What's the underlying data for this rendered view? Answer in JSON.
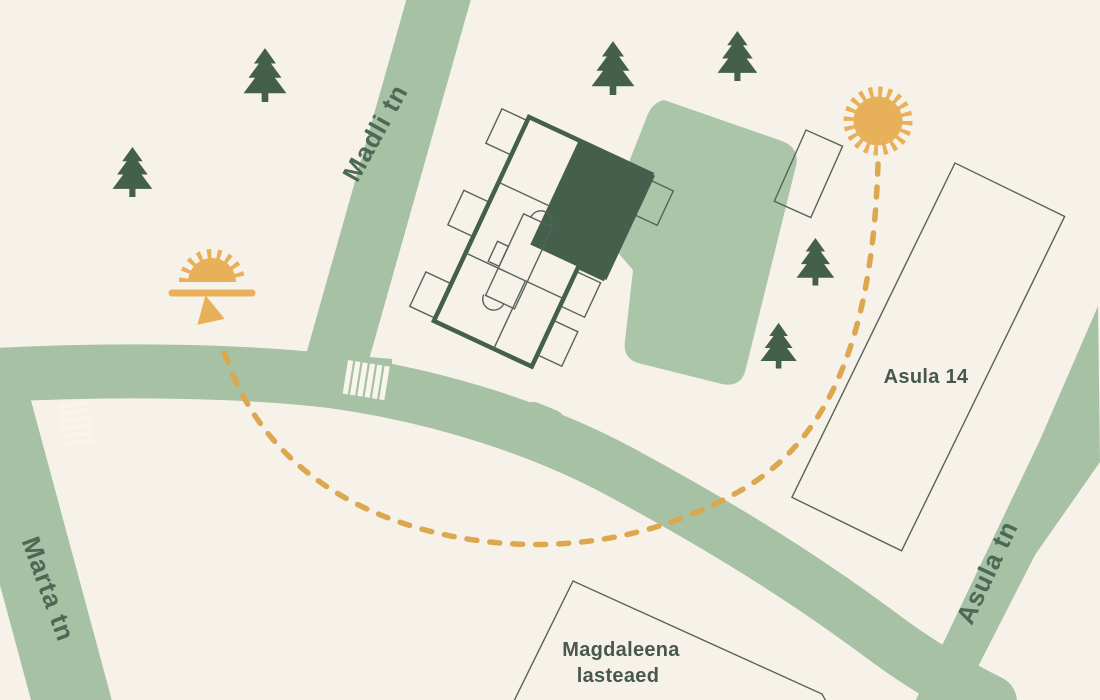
{
  "map": {
    "streets": [
      {
        "name": "Madli tn"
      },
      {
        "name": "Marta tn"
      },
      {
        "name": "Asula tn"
      }
    ],
    "buildings": {
      "asula14": {
        "label": "Asula 14"
      },
      "magdaleena": {
        "line1": "Magdaleena",
        "line2": "lasteaed"
      }
    },
    "icons": {
      "sun": "sun-icon",
      "sunrise": "sunrise-icon",
      "tree": "pine-tree-icon",
      "arrow": "route-arrow-icon"
    },
    "route": {
      "style": "dashed-arc",
      "from": "sun-icon",
      "to": "sunrise-icon"
    },
    "colors": {
      "bg": "#f7f2e9",
      "road": "#a6c1a3",
      "blob": "#abc5a9",
      "dark": "#44604d",
      "thin": "#56635a",
      "amber": "#e8b159",
      "dash": "#dba74f",
      "street": "#4b6954",
      "bldg": "#47584c",
      "stripe": "#f9f5ec"
    }
  }
}
